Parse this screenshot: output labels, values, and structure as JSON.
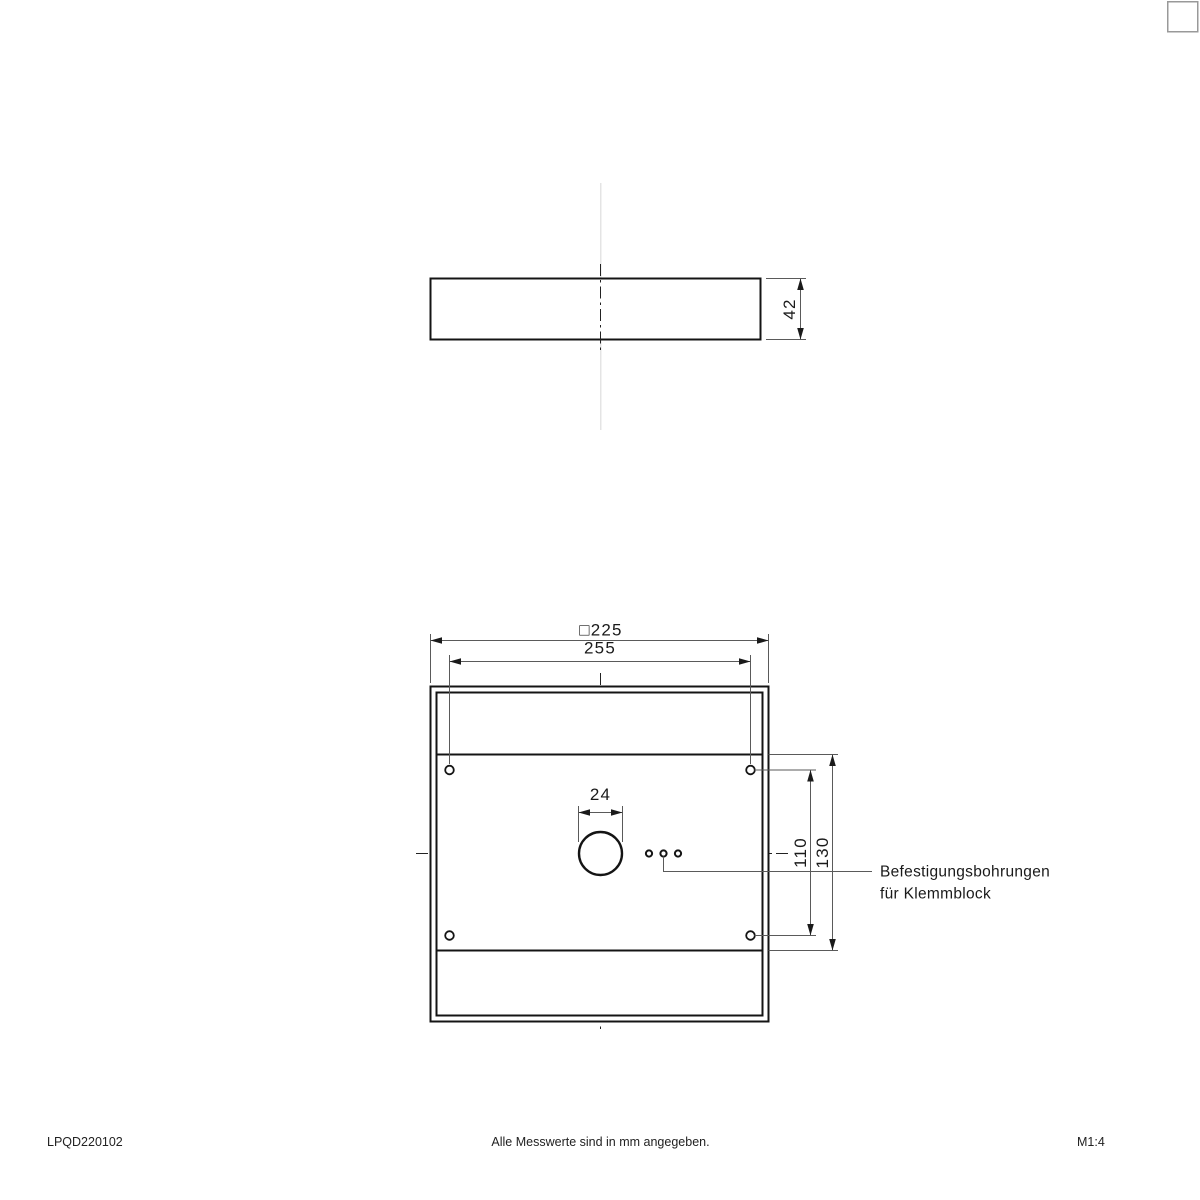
{
  "drawing": {
    "colors": {
      "object_line": "#141414",
      "dimension_line": "#5a5a5a",
      "faint_centerline": "#e4e4e4"
    },
    "side_view": {
      "height_dim": "42"
    },
    "plan_view": {
      "outer_dim": "□225",
      "hole_spacing_dim": "255",
      "cable_hole_dim": "24",
      "inner_span_dim": "110",
      "outer_span_dim": "130",
      "callout_line1": "Befestigungsbohrungen",
      "callout_line2": "für Klemmblock"
    },
    "footer": {
      "doc_number": "LPQD220102",
      "note": "Alle Messwerte sind in mm angegeben.",
      "scale": "M1:4"
    }
  }
}
